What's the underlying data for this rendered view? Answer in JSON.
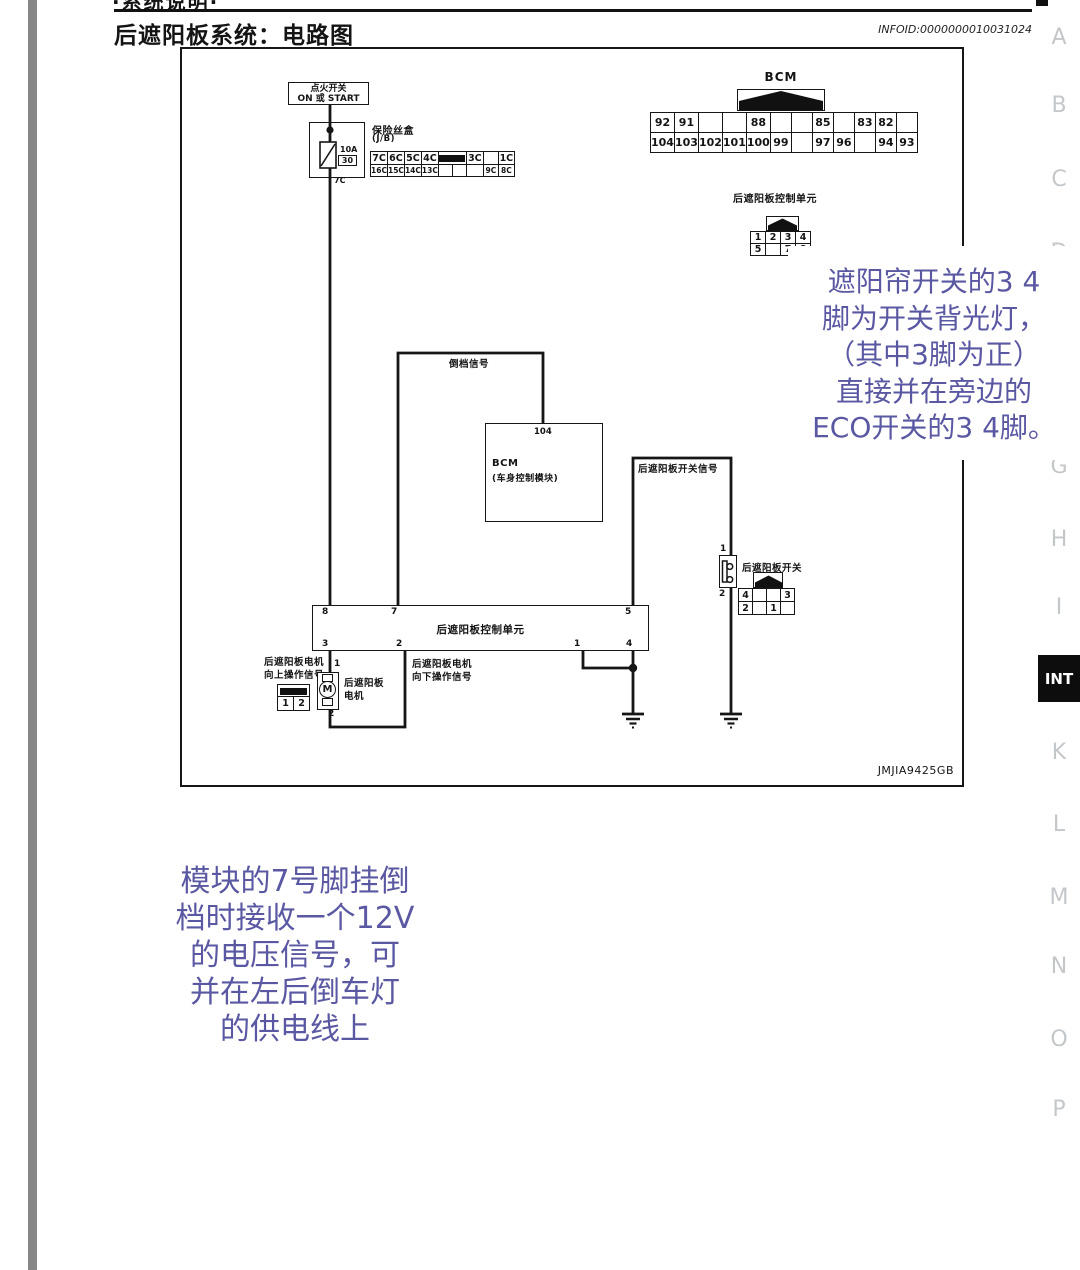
{
  "page": {
    "top_partial_text": "·系统说明·",
    "title": "后遮阳板系统：电路图",
    "infoid": "INFOID:0000000010031024",
    "figure_code": "JMJIA9425GB"
  },
  "side_rail": {
    "letters": [
      "A",
      "B",
      "C",
      "D",
      "G",
      "H",
      "I",
      "K",
      "L",
      "M",
      "N",
      "O",
      "P"
    ],
    "active_tab": "INT",
    "inactive_color": "#c4c7ca",
    "active_bg": "#0d0d0d"
  },
  "diagram": {
    "ignition_switch": {
      "line1": "点火开关",
      "line2": "ON 或 START"
    },
    "fuse_box": {
      "label_line1": "保险丝盒",
      "label_line2": "(J/B)",
      "fuse_rating": "10A",
      "fuse_number": "30",
      "wire_label": "7C"
    },
    "fuse_grid": {
      "row1": [
        "7C",
        "6C",
        "5C",
        "4C",
        "3C",
        "",
        "1C"
      ],
      "row2": [
        "16C",
        "15C",
        "14C",
        "13C",
        "",
        "",
        "",
        "9C",
        "8C"
      ]
    },
    "bcm_connector": {
      "label": "BCM",
      "row1": [
        "92",
        "91",
        "",
        "",
        "88",
        "",
        "",
        "85",
        "",
        "83",
        "82",
        ""
      ],
      "row2": [
        "104",
        "103",
        "102",
        "101",
        "100",
        "99",
        "",
        "97",
        "96",
        "",
        "94",
        "93"
      ]
    },
    "sunshade_connector": {
      "label": "后遮阳板控制单元",
      "row1": [
        "1",
        "2",
        "3",
        "4"
      ],
      "row2": [
        "5",
        "",
        "7",
        "8"
      ]
    },
    "reverse_signal_label": "倒档信号",
    "bcm_box": {
      "pin": "104",
      "line1": "BCM",
      "line2": "(车身控制模块)"
    },
    "switch_signal_label": "后遮阳板开关信号",
    "switch": {
      "pin_top": "1",
      "pin_bottom": "2",
      "label": "后遮阳板开关",
      "connector_row1": [
        "4",
        "",
        "",
        "3"
      ],
      "connector_row2": [
        "2",
        "",
        "1",
        ""
      ]
    },
    "control_unit": {
      "label": "后遮阳板控制单元",
      "pins_top": [
        "8",
        "7",
        "5"
      ],
      "pins_bottom": [
        "3",
        "2",
        "1",
        "4"
      ]
    },
    "motor": {
      "label_line1": "后遮阳板",
      "label_line2": "电机",
      "pin_top": "1",
      "pin_bottom": "2",
      "symbol": "M"
    },
    "motor_up_label": {
      "line1": "后遮阳板电机",
      "line2": "向上操作信号"
    },
    "motor_down_label": {
      "line1": "后遮阳板电机",
      "line2": "向下操作信号"
    },
    "motor_connector": {
      "cells": [
        "1",
        "2"
      ]
    }
  },
  "annotations": {
    "color": "#5a58a2",
    "right_note": {
      "lines": [
        "遮阳帘开关的3 4",
        "脚为开关背光灯，",
        "（其中3脚为正）",
        "直接并在旁边的",
        "ECO开关的3 4脚。"
      ]
    },
    "bottom_note": {
      "lines": [
        "模块的7号脚挂倒",
        "档时接收一个12V",
        "的电压信号，可",
        "并在左后倒车灯",
        "的供电线上"
      ]
    }
  }
}
